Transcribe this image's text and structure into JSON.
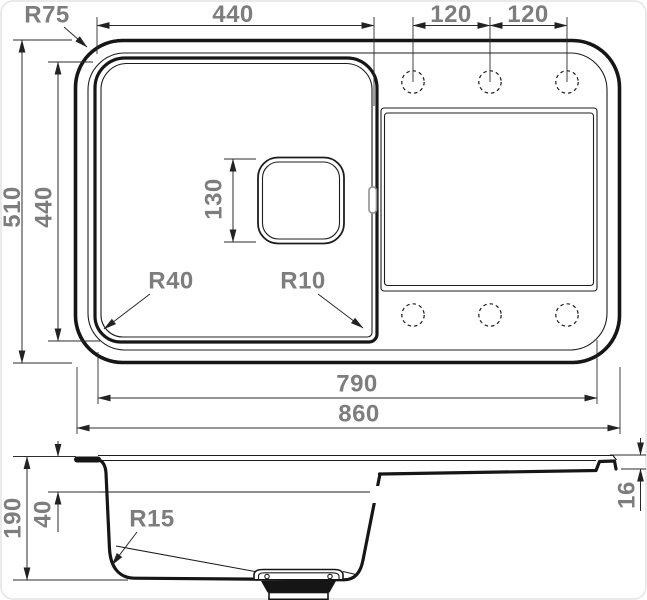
{
  "meta": {
    "drawing_type": "technical dimension drawing",
    "subject": "kitchen sink with bowl and drainboard",
    "views": [
      "top view",
      "side section view"
    ]
  },
  "colors": {
    "background": "#ffffff",
    "outline": "#161616",
    "dimension_lines": "#2b2b2b",
    "dimension_text": "#7d7d7d",
    "card_border": "#e4e4e4"
  },
  "top_view": {
    "labels": {
      "corner_radius": "R75",
      "bowl_width": "440",
      "hole_pitch_left": "120",
      "hole_pitch_right": "120",
      "overall_width": "510",
      "bowl_depth": "440",
      "drain_size": "130",
      "bowl_radius_bottom_left": "R40",
      "bowl_radius_bottom_right": "R10",
      "inner_length": "790",
      "overall_length": "860"
    },
    "tap_holes": {
      "count": 6,
      "style": "dashed circles"
    }
  },
  "side_view": {
    "labels": {
      "overall_height": "190",
      "rim_depth": "40",
      "bottom_radius": "R15",
      "wing_thickness": "16"
    }
  }
}
